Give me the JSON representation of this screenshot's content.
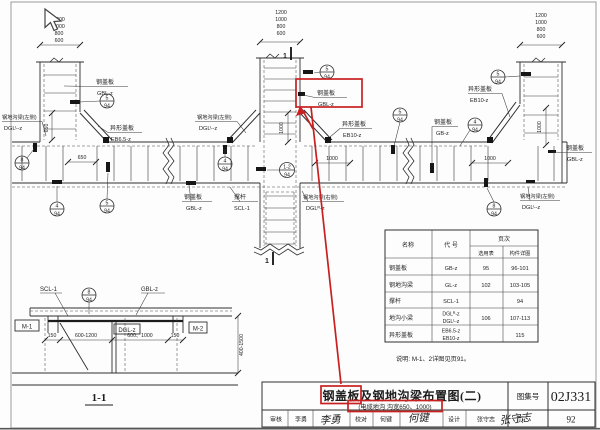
{
  "plan": {
    "dim_stack": [
      "1200",
      "1000",
      "800",
      "600"
    ],
    "dims": {
      "d650": "650",
      "d1000": "1000"
    },
    "marker": "1",
    "labels": [
      {
        "name": "钢盖板",
        "code": "GBL-z"
      },
      {
        "name": "异形盖板",
        "code": "EB6.5-z"
      },
      {
        "name": "钢地沟梁(左侧)",
        "code": "DGLᴸ-z"
      },
      {
        "name": "钢地沟梁(左侧)",
        "code": "DGLᴸ-z"
      },
      {
        "name": "钢盖板",
        "code": "GBL-z"
      },
      {
        "name": "撑杆",
        "code": "SCL-1"
      },
      {
        "name": "钢盖板",
        "code": "GBL-z"
      },
      {
        "name": "异形盖板",
        "code": "EB10-z"
      },
      {
        "name": "钢地沟梁(右侧)",
        "code": "DGLᴿ-z"
      },
      {
        "name": "钢盖板",
        "code": "GB-z"
      },
      {
        "name": "异形盖板",
        "code": "EB10-z"
      },
      {
        "name": "钢盖板",
        "code": "GBL-z"
      },
      {
        "name": "钢地沟梁(左侧)",
        "code": "DGLᴸ-z"
      }
    ],
    "bubbles": [
      {
        "num": "5",
        "page": "94"
      },
      {
        "num": "8",
        "page": "94"
      },
      {
        "num": "4",
        "page": "94"
      },
      {
        "num": "5",
        "page": "94"
      },
      {
        "num": "4",
        "page": "94"
      },
      {
        "num": "1-2",
        "page": "94"
      },
      {
        "num": "5",
        "page": "94"
      },
      {
        "num": "5",
        "page": "94"
      },
      {
        "num": "4",
        "page": "94"
      },
      {
        "num": "5",
        "page": "94"
      },
      {
        "num": "8",
        "page": "94"
      },
      {
        "num": "8",
        "page": "94"
      }
    ]
  },
  "section": {
    "title": "1-1",
    "labels": {
      "scl": "SCL-1",
      "gbl": "GBL-z",
      "m1": "M-1",
      "m2": "M-2",
      "dgl": "DGL-z"
    },
    "dims": [
      "150",
      "600-1200",
      "600、1000",
      "150"
    ],
    "vdim": "400-1500"
  },
  "table": {
    "h_name": "名称",
    "h_code": "代 号",
    "h_page": "页次",
    "h_sel": "选用表",
    "h_det": "构件详图",
    "rows": [
      {
        "name": "钢盖板",
        "code": "GB-z",
        "sel": "95",
        "det": "96-101"
      },
      {
        "name": "钢地沟梁",
        "code": "GL-z",
        "sel": "102",
        "det": "103-105"
      },
      {
        "name": "撑杆",
        "code": "SCL-1",
        "det": "94"
      },
      {
        "name": "地沟小梁",
        "code": "DGLᴿ-z",
        "code2": "DGLᴸ-z",
        "sel": "106",
        "det": "107-113"
      },
      {
        "name": "异形盖板",
        "code": "EB6.5-z",
        "code2": "EB10-z",
        "det": "115"
      }
    ]
  },
  "note": "说明: M-1、2详图见页91。",
  "titleblock": {
    "title": "钢盖板及钢地沟梁布置图(二)",
    "subtitle": "(电缆地沟 沟宽650、1000)",
    "atlas_label": "图集号",
    "atlas_no": "02J331",
    "page_label": "页",
    "page_no": "92",
    "cells": {
      "review": "审核",
      "review_name": "李勇",
      "check": "校对",
      "check_name": "何键",
      "design": "设计",
      "design_name": "张守志"
    },
    "sigs": {
      "review": "李勇",
      "check": "何键",
      "design": "张守志"
    }
  }
}
